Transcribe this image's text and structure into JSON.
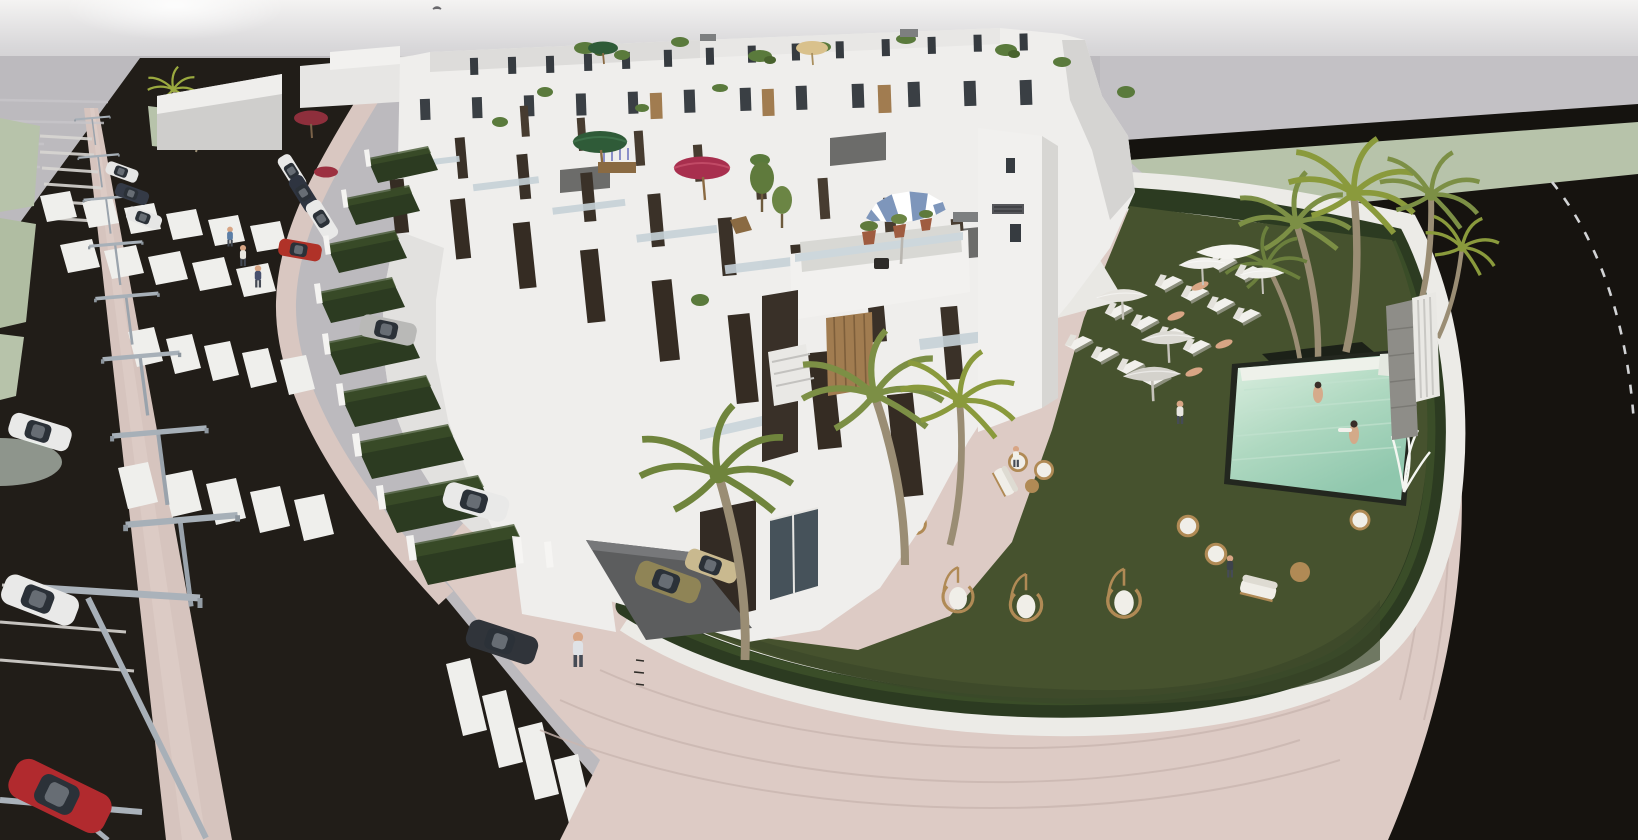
{
  "meta": {
    "kind": "architectural-3d-aerial-render",
    "description": "Aerial 3D architectural visualization of a modern white townhouse development: a diagonal street with pink paved median, street lamps, zebra crosswalks and parked cars on the left; rows of white flat-roofed townhouses with dark terrace panels, roof terraces and colored parasols in the middle; a walled communal garden on the right with dark lawn, white sun loungers, parasols, wicker and hanging chairs, palm trees and a turquoise pool with two swimmers; a wide curved pink sidewalk and a dark rear road with dashed line wrap the corner.",
    "width_px": 1638,
    "height_px": 840,
    "visible_text": ""
  },
  "palette": {
    "sky_top": "#f3f2f1",
    "sky": "#c7c5c9",
    "ground": "#bcbabe",
    "grass_verge": "#b7c3aa",
    "asphalt": "#1f1b17",
    "asphalt_dark": "#121110",
    "pavement": "#d9c7c1",
    "pavement_light": "#e6d9d4",
    "lawn": "#46522e",
    "lawn_dark": "#3a472a",
    "hedge": "#2c3b21",
    "building_white": "#efeeec",
    "building_shadow": "#d5d4d2",
    "panel_brown": "#3a3128",
    "window_dark": "#363b40",
    "door_wood": "#a17c50",
    "pool_shallow": "#dff0e2",
    "pool_deep": "#8fc7ad",
    "pool_glow": "#e9f8ec",
    "umbrella_green": "#2f5b38",
    "umbrella_magenta": "#a82f4e",
    "umbrella_red": "#8e2f3c",
    "umbrella_tan": "#d9c18c",
    "umbrella_stripe_blue": "#7e96bb",
    "parasol_white": "#efeeea",
    "wicker": "#b08a55",
    "cushion": "#f0eee8",
    "car_white": "#e9e9e8",
    "car_dark": "#2e3440",
    "car_red": "#b12a2e",
    "car_khaki": "#8f8456",
    "lamp_metal": "#9aa3ac",
    "skin": "#d8a584",
    "glass": "#c6d2d8",
    "palm_green": "#7c8f45",
    "palm_trunk": "#9a8d74"
  },
  "scene": {
    "streets": {
      "main_street": {
        "orientation": "diagonal top-left to bottom",
        "median_walkway": true,
        "street_lamps": 9,
        "crosswalks": 5,
        "parking_bay_lines": true
      },
      "rear_street": {
        "position": "top-right",
        "dashed_center_line": true
      }
    },
    "vehicles": {
      "driving_cars": 3,
      "parked_roadside_cars": 3,
      "front_yard_cars": 5,
      "red_car_bottom_left": 1
    },
    "buildings": {
      "type": "terraced white townhouses",
      "rows": 3,
      "roof_terraces": true,
      "roof_parasols": [
        {
          "color_name": "green",
          "hex": "#2f5b38"
        },
        {
          "color_name": "green",
          "hex": "#2f5b38"
        },
        {
          "color_name": "tan",
          "hex": "#d9c18c"
        },
        {
          "color_name": "magenta",
          "hex": "#a82f4e"
        },
        {
          "color_name": "dark-red",
          "hex": "#8e2f3c"
        },
        {
          "color_name": "blue-white-striped",
          "hex": "#7e96bb"
        }
      ],
      "front_gardens_with_hedges": 9
    },
    "communal_garden": {
      "perimeter": "white wall topped with hedge, rounded corner",
      "pool": {
        "water": "pale turquoise",
        "swimmers": 2,
        "white_steps": true,
        "stone_feature_wall": true
      },
      "sun_loungers": 14,
      "lawn_parasols": 5,
      "hanging_egg_chairs": 3,
      "wicker_seating_groups": 3,
      "palm_trees": 7
    },
    "people": {
      "sidewalk_pedestrians": 3,
      "standing_person": 1,
      "sunbathers": 4,
      "garden_sitters": 5,
      "lawn_walker": 1,
      "swimmers": 2
    },
    "bird_in_sky": 1
  }
}
